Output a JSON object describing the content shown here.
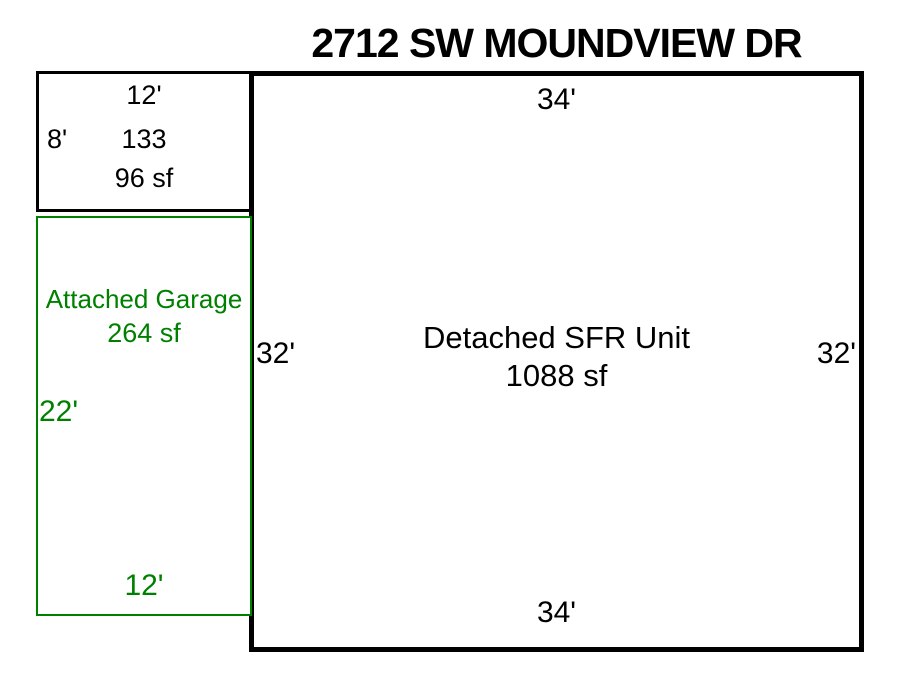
{
  "title": "2712 SW MOUNDVIEW DR",
  "colors": {
    "outline": "#000000",
    "garage_green": "#008000",
    "background": "#ffffff"
  },
  "main_unit": {
    "name": "Detached SFR Unit",
    "area": "1088 sf",
    "dim_top": "34'",
    "dim_bottom": "34'",
    "dim_left": "32'",
    "dim_right": "32'"
  },
  "structure_133": {
    "dim_top": "12'",
    "dim_left": "8'",
    "code": "133",
    "area": "96 sf"
  },
  "garage": {
    "name": "Attached Garage",
    "area": "264 sf",
    "dim_left": "22'",
    "dim_bottom": "12'"
  }
}
